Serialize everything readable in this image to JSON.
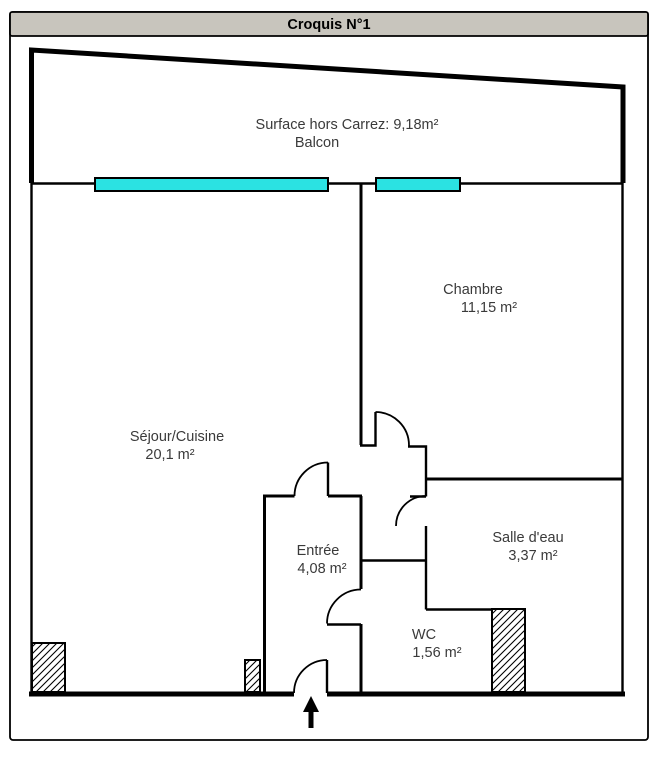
{
  "title": "Croquis N°1",
  "colors": {
    "titlebar_bg": "#c8c5bd",
    "window_glass": "#2be2e2",
    "wall": "#000000",
    "label_text": "#3a3a3a"
  },
  "balcony": {
    "surface_label": "Surface hors Carrez: 9,18m²",
    "name": "Balcon"
  },
  "rooms": [
    {
      "name": "Séjour/Cuisine",
      "area": "20,1 m²"
    },
    {
      "name": "Chambre",
      "area": "11,15 m²"
    },
    {
      "name": "Entrée",
      "area": "4,08 m²"
    },
    {
      "name": "Salle d'eau",
      "area": "3,37 m²"
    },
    {
      "name": "WC",
      "area": "1,56 m²"
    }
  ],
  "icons": {
    "entrance_arrow": "up-arrow"
  }
}
